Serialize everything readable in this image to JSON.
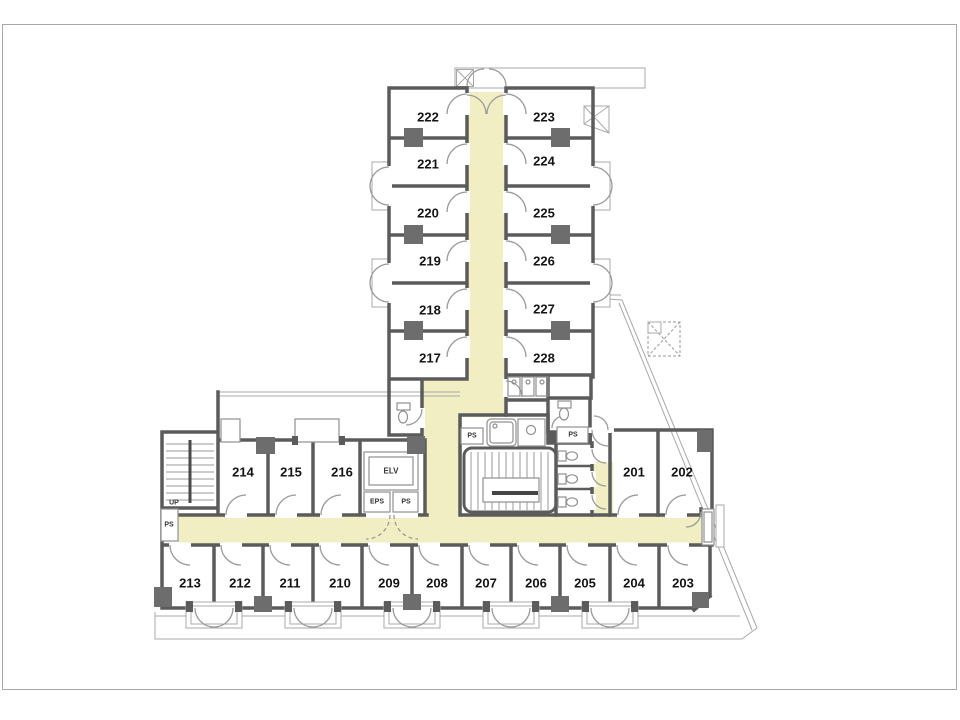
{
  "plan": {
    "rooms": {
      "tower_left": [
        "222",
        "221",
        "220",
        "219",
        "218",
        "217"
      ],
      "tower_right": [
        "223",
        "224",
        "225",
        "226",
        "227",
        "228"
      ],
      "west": [
        "214",
        "215",
        "216"
      ],
      "east": [
        "201",
        "202"
      ],
      "south": [
        "213",
        "212",
        "211",
        "210",
        "209",
        "208",
        "207",
        "206",
        "205",
        "204",
        "203"
      ]
    },
    "labels": {
      "elevator": "ELV",
      "eps": "EPS",
      "ps": "PS",
      "up": "UP"
    },
    "colors": {
      "corridor": "#f0eec2",
      "wall": "#5b5b5b",
      "pillar": "#6d6d6d",
      "thin_line": "#a8a8a8",
      "room_fill": "#ffffff",
      "text": "#141414"
    }
  }
}
